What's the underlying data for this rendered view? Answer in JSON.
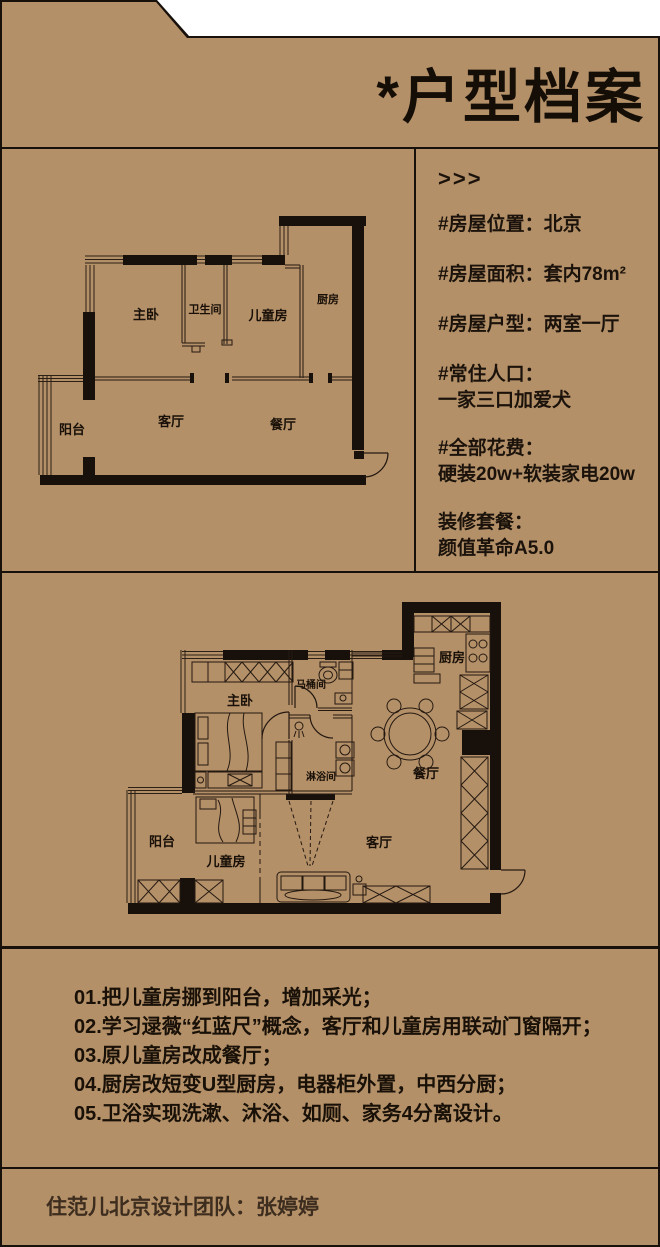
{
  "header": {
    "title": "*户型档案"
  },
  "info": {
    "arrow": ">>>",
    "items": [
      {
        "line1": "#房屋位置：北京"
      },
      {
        "line1": "#房屋面积：套内78m²"
      },
      {
        "line1": "#房屋户型：两室一厅"
      },
      {
        "line1": "#常住人口：",
        "line2": "一家三口加爱犬"
      },
      {
        "line1": "#全部花费：",
        "line2": "硬装20w+软装家电20w"
      },
      {
        "line1": "装修套餐：",
        "line2": "颜值革命A5.0"
      }
    ]
  },
  "plan_before": {
    "rooms": {
      "master": "主卧",
      "bath": "卫生间",
      "kids": "儿童房",
      "kitchen": "厨房",
      "balcony": "阳台",
      "living": "客厅",
      "dining": "餐厅"
    }
  },
  "plan_after": {
    "rooms": {
      "master": "主卧",
      "toilet": "马桶间",
      "kitchen": "厨房",
      "dining": "餐厅",
      "living": "客厅",
      "balcony": "阳台",
      "kids": "儿童房",
      "shower": "淋浴间"
    }
  },
  "notes": {
    "items": [
      "01.把儿童房挪到阳台，增加采光；",
      "02.学习逯薇“红蓝尺”概念，客厅和儿童房用联动门窗隔开；",
      "03.原儿童房改成餐厅；",
      "04.厨房改短变U型厨房，电器柜外置，中西分厨；",
      "05.卫浴实现洗漱、沐浴、如厕、家务4分离设计。"
    ]
  },
  "footer": {
    "credit": "住范儿北京设计团队：张婷婷"
  },
  "colors": {
    "background": "#b49068",
    "ink": "#18110b",
    "thin_line": "#2c1f15",
    "footer_text": "#3d2d1e"
  }
}
